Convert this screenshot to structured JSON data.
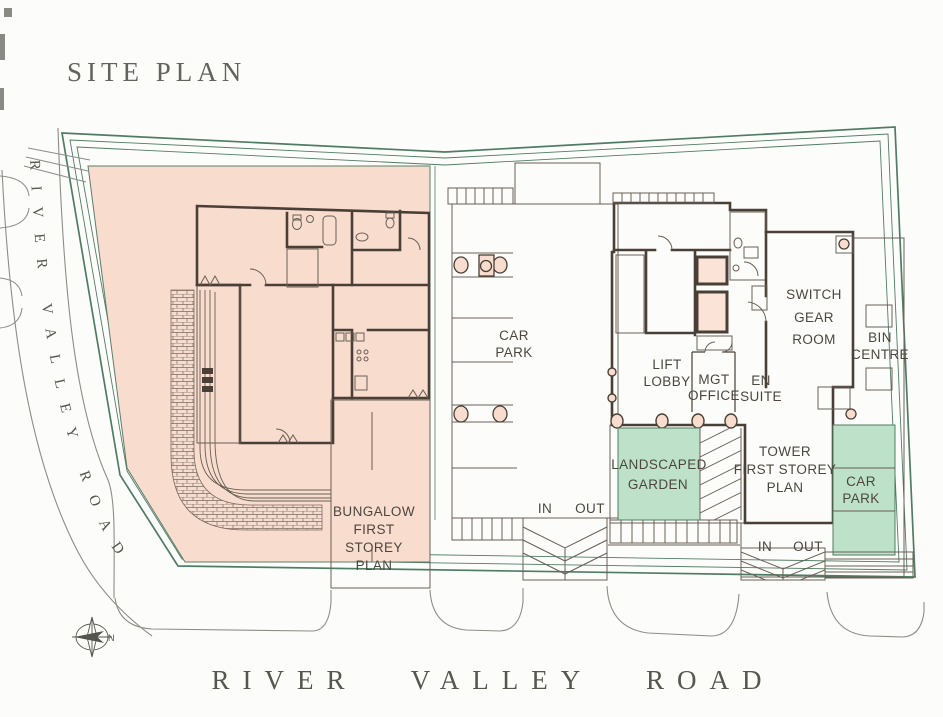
{
  "title": "SITE PLAN",
  "roads": {
    "left_label": "RIVER VALLEY ROAD",
    "bottom_label": "RIVER VALLEY ROAD"
  },
  "compass": {
    "north_label": "N"
  },
  "colors": {
    "site_green": "#d6e9d8",
    "accent_green": "#bee2c9",
    "boundary_green": "#4f7d63",
    "plan_pink": "#f8dcce",
    "building_pink": "#fbe3d7",
    "wall_dark": "#4a3f36",
    "text_gray": "#4c463f",
    "road_gray": "#8d8d88"
  },
  "areas": {
    "bungalow_plan": {
      "lines": [
        "BUNGALOW",
        "FIRST",
        "STOREY",
        "PLAN"
      ]
    },
    "tower_plan": {
      "lines": [
        "TOWER",
        "FIRST STOREY",
        "PLAN"
      ]
    },
    "car_park_central": {
      "lines": [
        "CAR",
        "PARK"
      ]
    },
    "car_park_east": {
      "lines": [
        "CAR",
        "PARK"
      ]
    },
    "lift_lobby": {
      "lines": [
        "LIFT",
        "LOBBY"
      ]
    },
    "mgt_office": {
      "lines": [
        "MGT",
        "OFFICE"
      ]
    },
    "en_suite": {
      "lines": [
        "EN",
        "SUITE"
      ]
    },
    "switch_gear_room": {
      "lines": [
        "SWITCH",
        "GEAR",
        "ROOM"
      ]
    },
    "bin_centre": {
      "lines": [
        "BIN",
        "CENTRE"
      ]
    },
    "landscaped_garden": {
      "lines": [
        "LANDSCAPED",
        "GARDEN"
      ]
    },
    "driveway_central": {
      "in": "IN",
      "out": "OUT"
    },
    "driveway_east": {
      "in": "IN",
      "out": "OUT"
    }
  }
}
